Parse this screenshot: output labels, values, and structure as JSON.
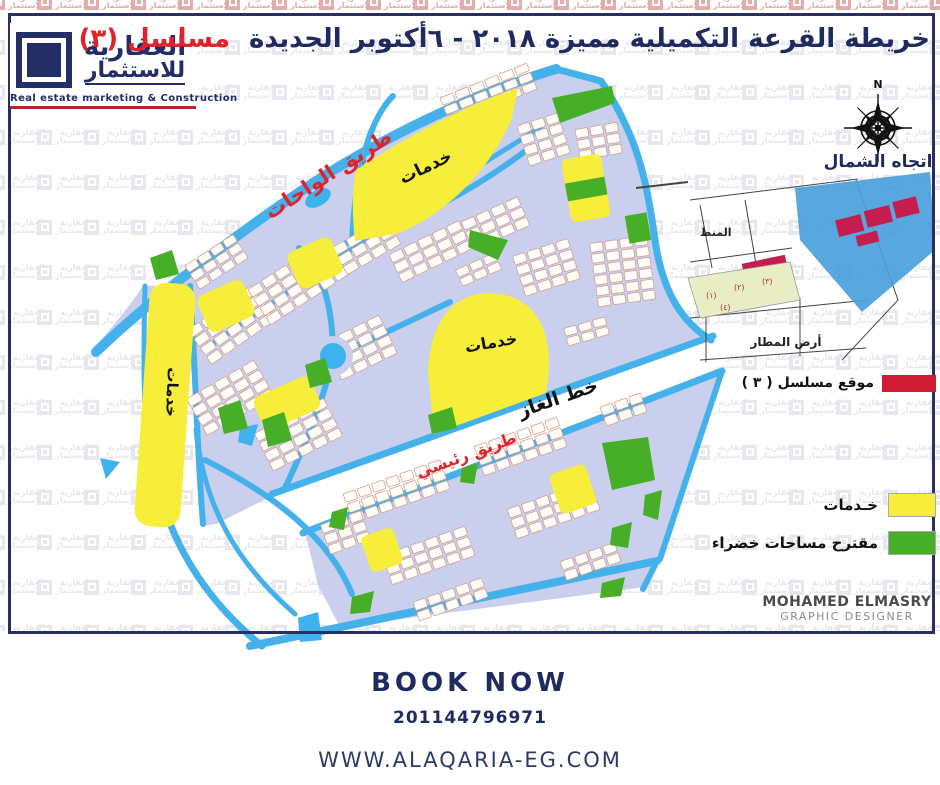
{
  "brand": {
    "name_line1": "العقارية",
    "name_line2": "للاستثمار",
    "tagline": "Real estate marketing & Construction"
  },
  "title": {
    "main": "خريطة القرعة التكميلية مميزة ٢٠١٨ - ٦أكتوبر الجديدة",
    "serial": "مسلسل (٣)"
  },
  "compass": {
    "north_letter": "N",
    "label": "اتجاه الشمال"
  },
  "map_labels": {
    "oases_road": "طريق الواحات",
    "services": "خدمات",
    "gas_line": "خط الغاز",
    "main_road": "طريق رئيسي"
  },
  "inset": {
    "airport_label": "أرض المطار",
    "district_label": "المنط",
    "plot_numbers": [
      "(١)",
      "(٢)",
      "(٣)",
      "(٤)"
    ],
    "location_label": "موقع مسلسل ( ٣ )"
  },
  "legend": {
    "services": "خـدمات",
    "green": "مقترح مساحات خضراء"
  },
  "credit": {
    "name": "MOHAMED ELMASRY",
    "role": "GRAPHIC DESIGNER"
  },
  "footer": {
    "cta": "BOOK NOW",
    "phone": "201144796971",
    "website": "WWW.ALAQARIA-EG.COM"
  },
  "watermark": {
    "line1": "العقارية",
    "line2": "للاستثمار"
  },
  "colors": {
    "navy": "#1f2a5e",
    "red": "#e0232b",
    "road_blue": "#45b1ea",
    "block_lavender": "#c9cfed",
    "services_yellow": "#f6ee3b",
    "green": "#46ae27",
    "location_crimson": "#cf1b34",
    "inset_blue": "#4aa0dc"
  }
}
